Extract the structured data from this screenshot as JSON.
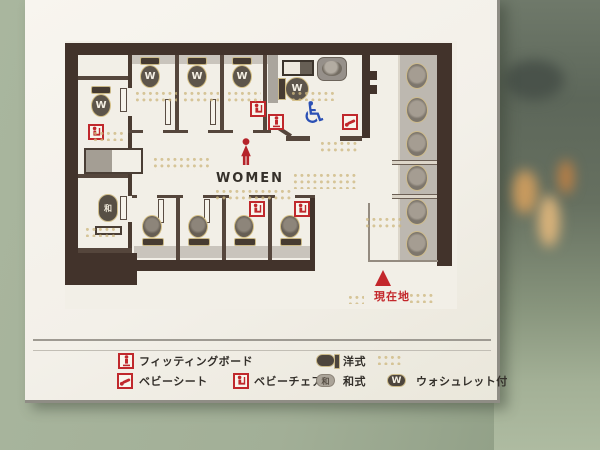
{
  "sign": {
    "map": {
      "room_label": "WOMEN",
      "current_location_label": "現在地",
      "washlet_letter": "W",
      "squat_letter": "和",
      "wheelchair_glyph": "♿",
      "fixtures": {
        "washlet_stalls": 5,
        "western_stalls": 4,
        "squat_stalls": 1,
        "accessible_room": 1,
        "sinks": 6,
        "baby_chair_marks": 4,
        "baby_sheet_marks": 2,
        "fitting_board_marks": 2
      }
    },
    "legend": {
      "washlet_letter": "W",
      "squat_letter": "和",
      "items": [
        {
          "id": "fitting-board",
          "label": "フィッティングボード"
        },
        {
          "id": "baby-sheet",
          "label": "ベビーシート"
        },
        {
          "id": "baby-chair",
          "label": "ベビーチェア"
        },
        {
          "id": "western-toilet",
          "label": "洋式"
        },
        {
          "id": "squat-toilet",
          "label": "和式"
        },
        {
          "id": "washlet",
          "label": "ウォシュレット付"
        }
      ]
    },
    "colors": {
      "wall_brown": "#42332b",
      "accent_red": "#c3272b",
      "accessible_blue": "#2b50b5",
      "counter_gray": "#bdb8b0",
      "sign_white": "#f3f0e9",
      "glass_green": "#9cab92"
    }
  }
}
